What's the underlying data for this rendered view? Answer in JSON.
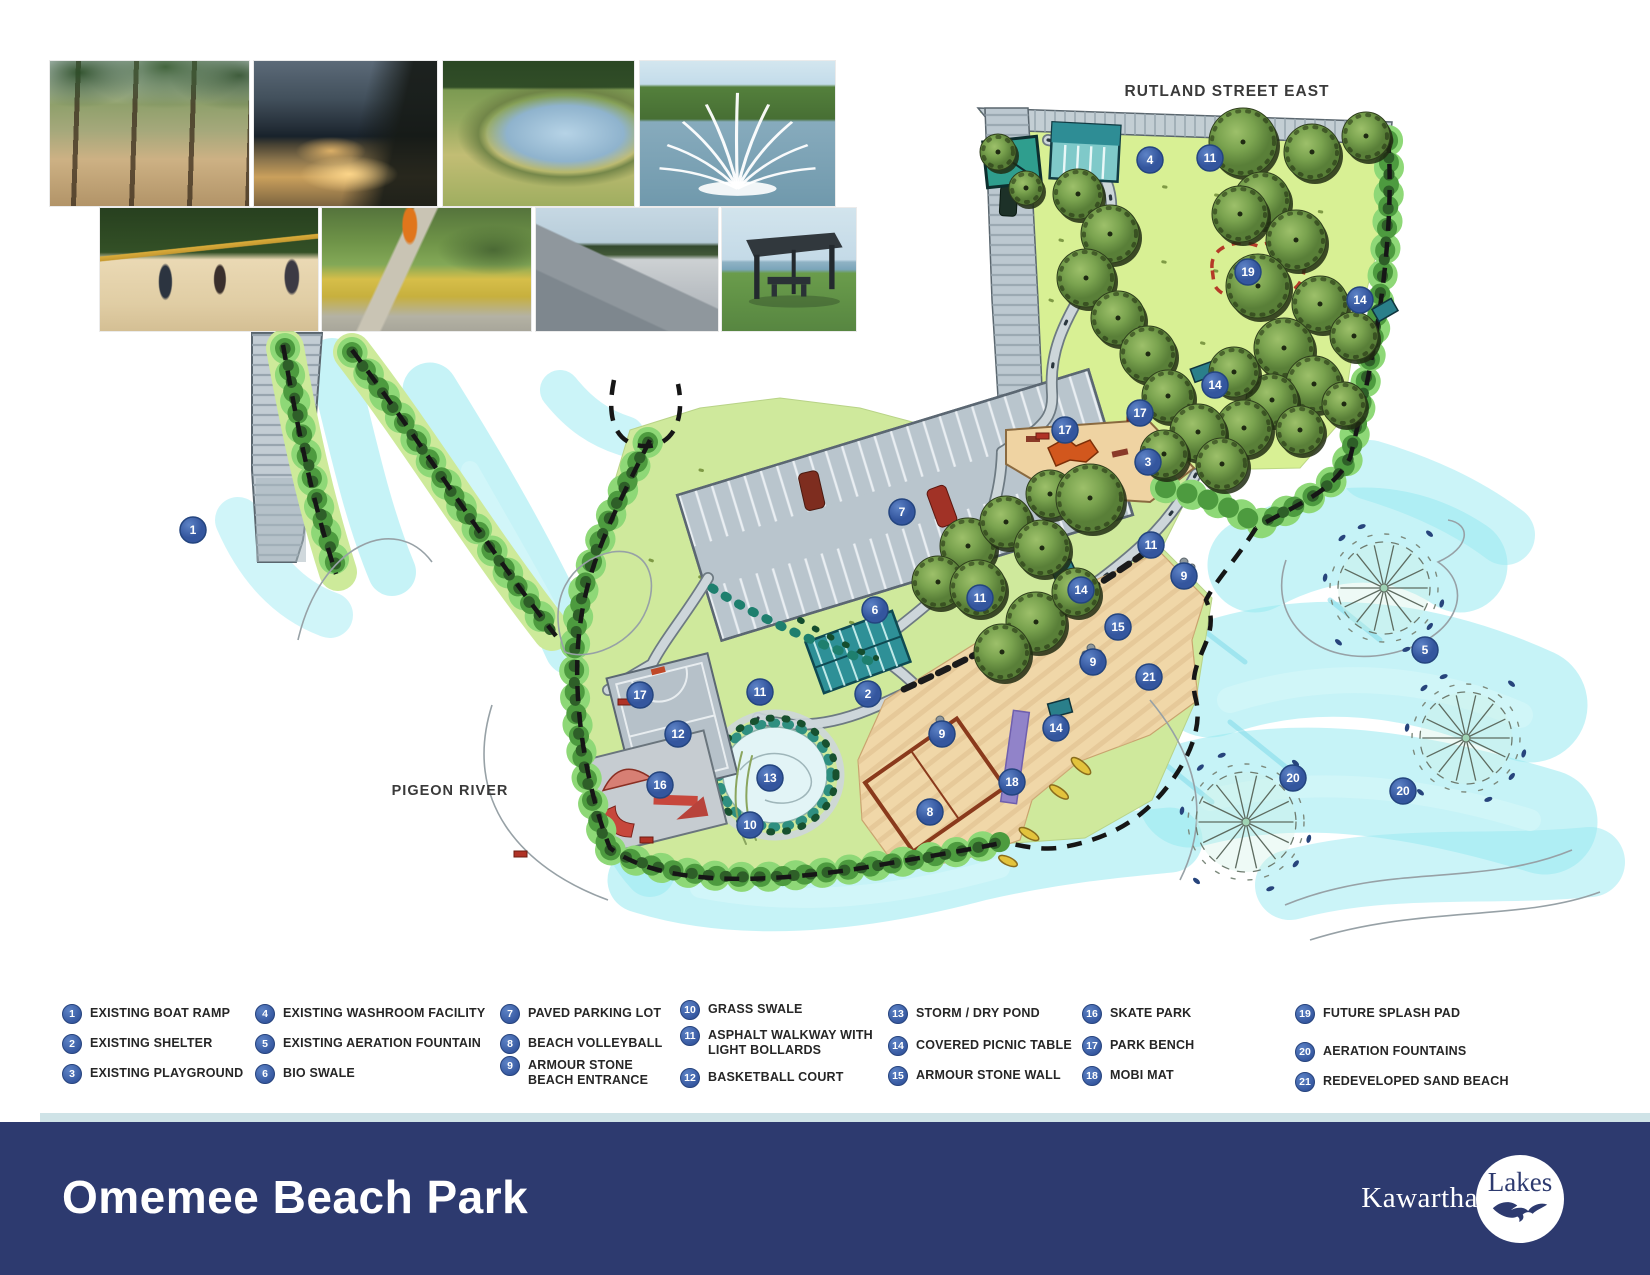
{
  "map": {
    "street_label": "RUTLAND STREET EAST",
    "river_label": "PIGEON RIVER",
    "markers": [
      {
        "n": "1",
        "x": 193,
        "y": 530
      },
      {
        "n": "4",
        "x": 1150,
        "y": 160
      },
      {
        "n": "11",
        "x": 1210,
        "y": 158
      },
      {
        "n": "19",
        "x": 1248,
        "y": 272
      },
      {
        "n": "14",
        "x": 1360,
        "y": 300
      },
      {
        "n": "14",
        "x": 1215,
        "y": 385
      },
      {
        "n": "17",
        "x": 1065,
        "y": 430
      },
      {
        "n": "17",
        "x": 1140,
        "y": 413
      },
      {
        "n": "3",
        "x": 1148,
        "y": 462
      },
      {
        "n": "7",
        "x": 902,
        "y": 512
      },
      {
        "n": "11",
        "x": 1151,
        "y": 545
      },
      {
        "n": "9",
        "x": 1184,
        "y": 576
      },
      {
        "n": "11",
        "x": 980,
        "y": 598
      },
      {
        "n": "14",
        "x": 1081,
        "y": 590
      },
      {
        "n": "6",
        "x": 875,
        "y": 610
      },
      {
        "n": "15",
        "x": 1118,
        "y": 627
      },
      {
        "n": "9",
        "x": 1093,
        "y": 662
      },
      {
        "n": "21",
        "x": 1149,
        "y": 677
      },
      {
        "n": "2",
        "x": 868,
        "y": 694
      },
      {
        "n": "17",
        "x": 640,
        "y": 695
      },
      {
        "n": "11",
        "x": 760,
        "y": 692
      },
      {
        "n": "14",
        "x": 1056,
        "y": 728
      },
      {
        "n": "9",
        "x": 942,
        "y": 734
      },
      {
        "n": "12",
        "x": 678,
        "y": 734
      },
      {
        "n": "13",
        "x": 770,
        "y": 778
      },
      {
        "n": "18",
        "x": 1012,
        "y": 782
      },
      {
        "n": "16",
        "x": 660,
        "y": 785
      },
      {
        "n": "10",
        "x": 750,
        "y": 825
      },
      {
        "n": "8",
        "x": 930,
        "y": 812
      },
      {
        "n": "5",
        "x": 1425,
        "y": 650
      },
      {
        "n": "20",
        "x": 1293,
        "y": 778
      },
      {
        "n": "20",
        "x": 1403,
        "y": 791
      }
    ]
  },
  "legend": {
    "items": [
      {
        "n": "1",
        "label": "EXISTING BOAT RAMP"
      },
      {
        "n": "2",
        "label": "EXISTING SHELTER"
      },
      {
        "n": "3",
        "label": "EXISTING PLAYGROUND"
      },
      {
        "n": "4",
        "label": "EXISTING WASHROOM FACILITY"
      },
      {
        "n": "5",
        "label": "EXISTING AERATION FOUNTAIN"
      },
      {
        "n": "6",
        "label": "BIO SWALE"
      },
      {
        "n": "7",
        "label": "PAVED PARKING LOT"
      },
      {
        "n": "8",
        "label": "BEACH VOLLEYBALL"
      },
      {
        "n": "9",
        "label": "ARMOUR STONE BEACH ENTRANCE"
      },
      {
        "n": "10",
        "label": "GRASS SWALE"
      },
      {
        "n": "11",
        "label": "ASPHALT WALKWAY WITH LIGHT BOLLARDS"
      },
      {
        "n": "12",
        "label": "BASKETBALL COURT"
      },
      {
        "n": "13",
        "label": "STORM / DRY POND"
      },
      {
        "n": "14",
        "label": "COVERED PICNIC TABLE"
      },
      {
        "n": "15",
        "label": "ARMOUR STONE WALL"
      },
      {
        "n": "16",
        "label": "SKATE PARK"
      },
      {
        "n": "17",
        "label": "PARK BENCH"
      },
      {
        "n": "18",
        "label": "MOBI MAT"
      },
      {
        "n": "19",
        "label": "FUTURE SPLASH PAD"
      },
      {
        "n": "20",
        "label": "AERATION FOUNTAINS"
      },
      {
        "n": "21",
        "label": "REDEVELOPED SAND BEACH"
      }
    ]
  },
  "photos": [
    {
      "id": "beach-forest-trail-photo"
    },
    {
      "id": "lit-pathway-dusk-photo"
    },
    {
      "id": "pond-grass-swale-photo"
    },
    {
      "id": "lake-aeration-fountain-photo"
    },
    {
      "id": "beach-volleyball-photo"
    },
    {
      "id": "playground-court-photo"
    },
    {
      "id": "skate-park-photo"
    },
    {
      "id": "picnic-shelter-photo"
    }
  ],
  "footer": {
    "title": "Omemee Beach Park",
    "logo_left": "Kawartha",
    "logo_right": "Lakes"
  },
  "colors": {
    "footer_navy": "#2d3a6f",
    "marker_blue": "#3d63ad",
    "accent_strip": "#cfe3e7",
    "water": "#9ce9f2",
    "land": "#cfe99c"
  }
}
